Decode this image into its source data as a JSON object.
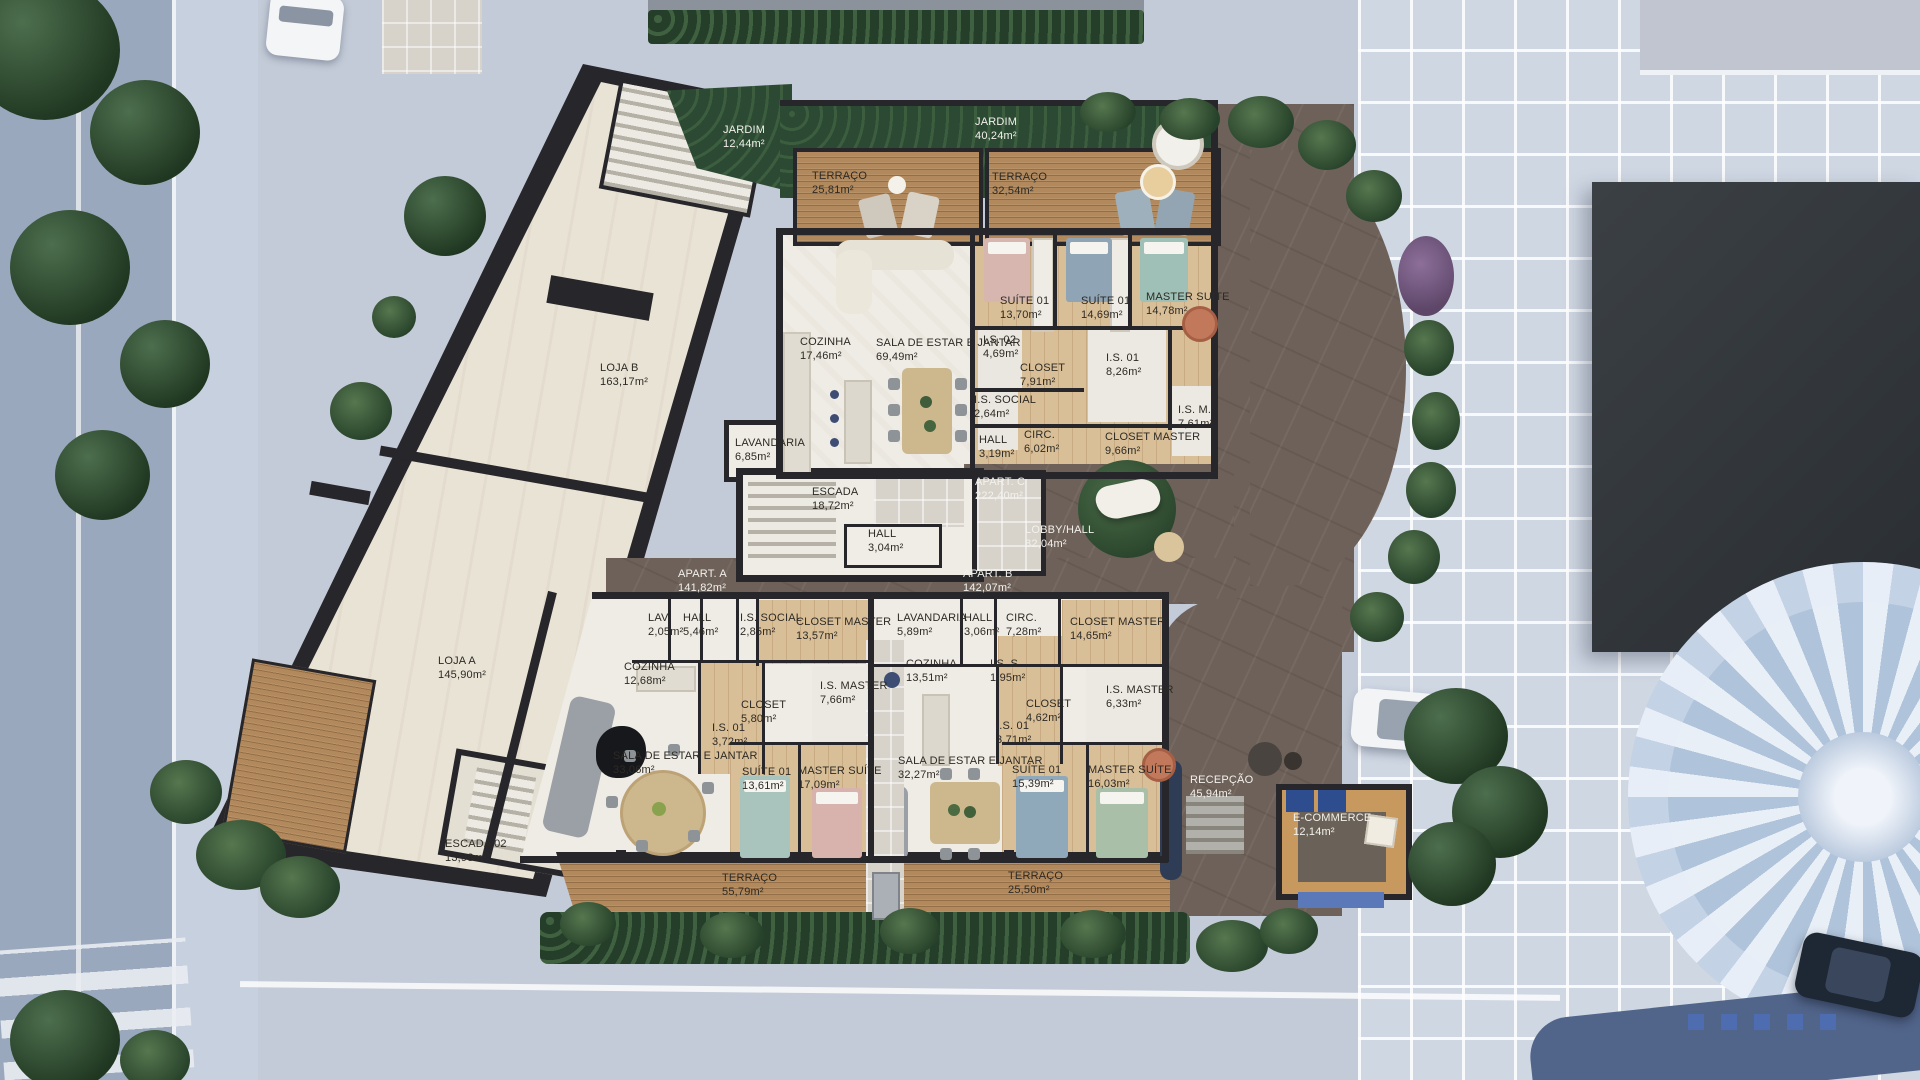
{
  "palette": {
    "street": "#9aa8bd",
    "sidewalk": "#c7d0de",
    "plaza": "#cfd7e3",
    "grass": "#2c4a33",
    "hedge": "#243e2a",
    "wood-deck": "#b2895c",
    "wood-floor": "#d9bf98",
    "wall": "#27262a",
    "floor-white": "#efece5",
    "loja-floor": "#e9e3d6",
    "drive": "#6e6159",
    "roof-dark": "#34383c",
    "accent-blue": "#5b79b8",
    "water": "#51648a"
  },
  "units": {
    "loja_a": {
      "name": "LOJA A",
      "area": "145,90m²"
    },
    "loja_b": {
      "name": "LOJA B",
      "area": "163,17m²"
    },
    "apart_a": {
      "name": "APART. A",
      "area": "141,82m²"
    },
    "apart_b": {
      "name": "APART. B",
      "area": "142,07m²"
    },
    "apart_c": {
      "name": "APART. C",
      "area": "222,40m²"
    }
  },
  "outdoor": {
    "jardim_left": {
      "name": "JARDIM",
      "area": "12,44m²"
    },
    "jardim_right": {
      "name": "JARDIM",
      "area": "40,24m²"
    },
    "terraco_top_left": {
      "name": "TERRAÇO",
      "area": "25,81m²"
    },
    "terraco_top_right": {
      "name": "TERRAÇO",
      "area": "32,54m²"
    },
    "terraco_bottom_left": {
      "name": "TERRAÇO",
      "area": "55,79m²"
    },
    "terraco_bottom_right": {
      "name": "TERRAÇO",
      "area": "25,50m²"
    }
  },
  "common": {
    "escada": {
      "name": "ESCADA",
      "area": "18,72m²"
    },
    "escada_02": {
      "name": "ESCADA 02",
      "area": "13,98m²"
    },
    "hall_core": {
      "name": "HALL",
      "area": "3,04m²"
    },
    "lobby_hall": {
      "name": "LOBBY/HALL",
      "area": "82,04m²"
    },
    "recepcao": {
      "name": "RECEPÇÃO",
      "area": "45,94m²"
    },
    "ecommerce": {
      "name": "E-COMMERCE",
      "area": "12,14m²"
    }
  },
  "apart_c_rooms": {
    "cozinha": {
      "name": "COZINHA",
      "area": "17,46m²"
    },
    "sala": {
      "name": "SALA DE ESTAR E JANTAR",
      "area": "69,49m²"
    },
    "suite01_a": {
      "name": "SUÍTE 01",
      "area": "13,70m²"
    },
    "suite01_b": {
      "name": "SUÍTE 01",
      "area": "14,69m²"
    },
    "master_suite": {
      "name": "MASTER SUÍTE",
      "area": "14,78m²"
    },
    "is02": {
      "name": "I.S. 02",
      "area": "4,69m²"
    },
    "closet": {
      "name": "CLOSET",
      "area": "7,91m²"
    },
    "is01": {
      "name": "I.S. 01",
      "area": "8,26m²"
    },
    "is_social": {
      "name": "I.S. SOCIAL",
      "area": "2,64m²"
    },
    "hall": {
      "name": "HALL",
      "area": "3,19m²"
    },
    "circ": {
      "name": "CIRC.",
      "area": "6,02m²"
    },
    "closet_master": {
      "name": "CLOSET MASTER",
      "area": "9,66m²"
    },
    "is_m": {
      "name": "I.S. M.",
      "area": "7,61m²"
    },
    "lavandaria": {
      "name": "LAVANDARIA",
      "area": "6,85m²"
    }
  },
  "apart_a_rooms": {
    "lav": {
      "name": "LAV.",
      "area": "2,05m²"
    },
    "hall": {
      "name": "HALL",
      "area": "5,46m²"
    },
    "is_social": {
      "name": "I.S. SOCIAL",
      "area": "2,85m²"
    },
    "closet_master": {
      "name": "CLOSET MASTER",
      "area": "13,57m²"
    },
    "cozinha": {
      "name": "COZINHA",
      "area": "12,68m²"
    },
    "closet": {
      "name": "CLOSET",
      "area": "5,80m²"
    },
    "is_master": {
      "name": "I.S. MASTER",
      "area": "7,66m²"
    },
    "is01": {
      "name": "I.S. 01",
      "area": "3,72m²"
    },
    "sala": {
      "name": "SALA DE ESTAR E JANTAR",
      "area": "33,06m²"
    },
    "suite01": {
      "name": "SUÍTE 01",
      "area": "13,61m²"
    },
    "master_suite": {
      "name": "MASTER SUÍTE",
      "area": "17,09m²"
    }
  },
  "apart_b_rooms": {
    "lavandaria": {
      "name": "LAVANDARIA",
      "area": "5,89m²"
    },
    "hall": {
      "name": "HALL",
      "area": "3,06m²"
    },
    "circ": {
      "name": "CIRC.",
      "area": "7,28m²"
    },
    "closet_master": {
      "name": "CLOSET MASTER",
      "area": "14,65m²"
    },
    "cozinha": {
      "name": "COZINHA",
      "area": "13,51m²"
    },
    "is_s": {
      "name": "I.S. S.",
      "area": "1,95m²"
    },
    "closet": {
      "name": "CLOSET",
      "area": "4,62m²"
    },
    "is01": {
      "name": "I.S. 01",
      "area": "3,71m²"
    },
    "is_master": {
      "name": "I.S. MASTER",
      "area": "6,33m²"
    },
    "sala": {
      "name": "SALA DE ESTAR E JANTAR",
      "area": "32,27m²"
    },
    "suite01": {
      "name": "SUÍTE 01",
      "area": "15,39m²"
    },
    "master_suite": {
      "name": "MASTER SUÍTE",
      "area": "16,03m²"
    }
  }
}
